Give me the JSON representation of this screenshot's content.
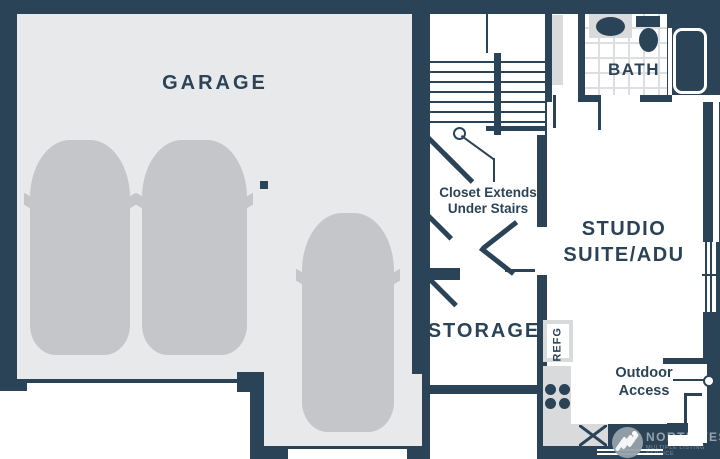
{
  "colors": {
    "wall": "#2b4357",
    "garage_floor": "#e8e9eb",
    "car": "#c5c6ca",
    "counter": "#d8dadc",
    "tile_line": "#dcdee1",
    "label": "#2b4357"
  },
  "rooms": {
    "garage": {
      "label": "GARAGE"
    },
    "storage": {
      "label": "STORAGE"
    },
    "studio": {
      "label_line1": "STUDIO",
      "label_line2": "SUITE/ADU"
    },
    "bath": {
      "label": "BATH"
    }
  },
  "annotations": {
    "closet_note_line1": "Closet Extends",
    "closet_note_line2": "Under Stairs",
    "outdoor_line1": "Outdoor",
    "outdoor_line2": "Access",
    "refrigerator": "REFG"
  },
  "watermark": {
    "brand": "NORTHWEST",
    "subtitle": "MULTIPLE LISTING SERVICE"
  }
}
